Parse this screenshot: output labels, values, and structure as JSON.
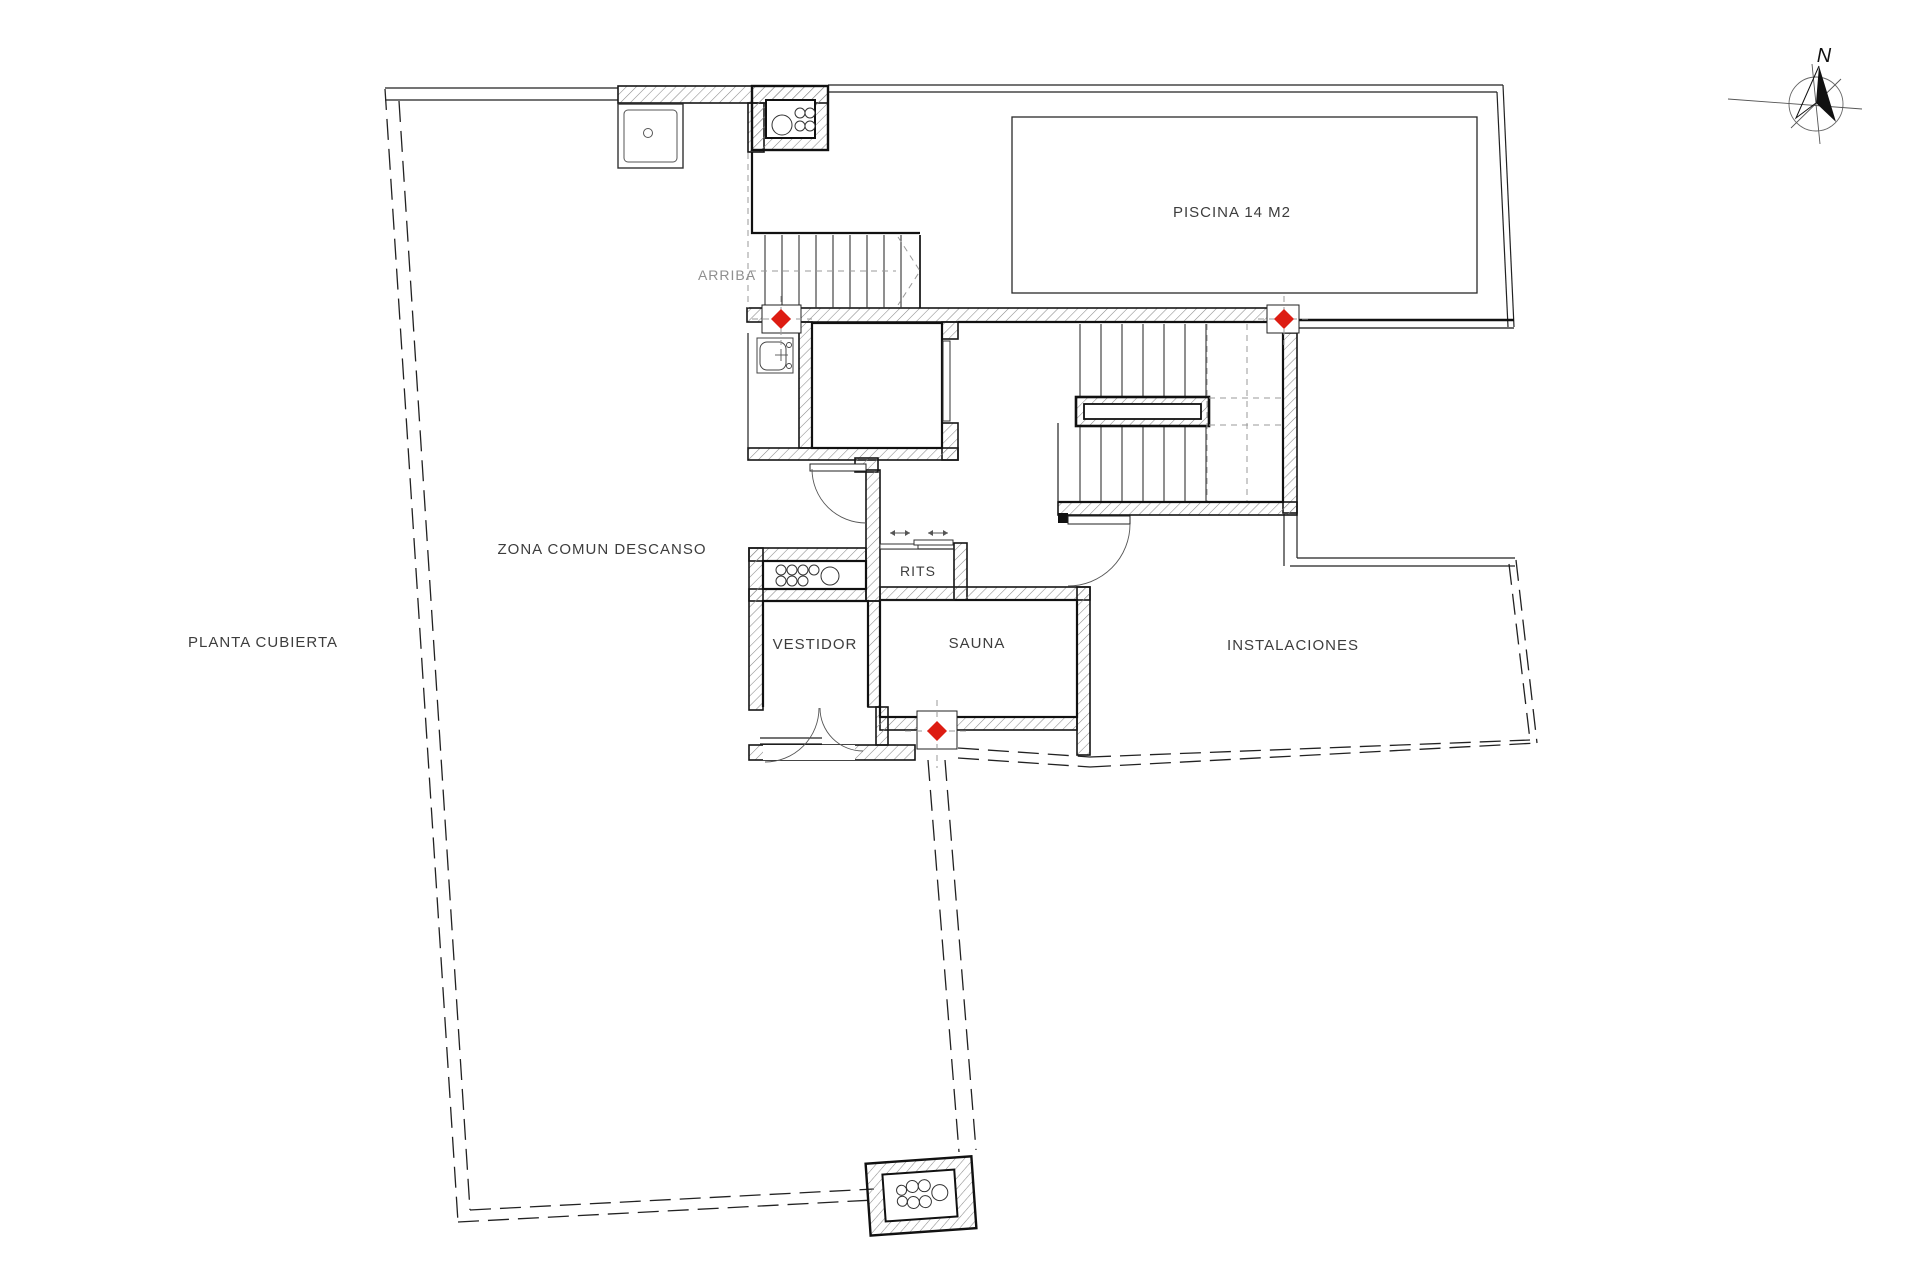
{
  "title": "PLANTA CUBIERTA",
  "plan": {
    "labels": {
      "plan_title": "PLANTA CUBIERTA",
      "arriba": "ARRIBA",
      "north": "N"
    },
    "rooms": [
      {
        "id": "zona-comun-descanso",
        "label": "ZONA COMUN DESCANSO"
      },
      {
        "id": "piscina",
        "label": "PISCINA 14 M2"
      },
      {
        "id": "rits",
        "label": "RITS"
      },
      {
        "id": "vestidor",
        "label": "VESTIDOR"
      },
      {
        "id": "sauna",
        "label": "SAUNA"
      },
      {
        "id": "instalaciones",
        "label": "INSTALACIONES"
      }
    ],
    "markers": {
      "symbol": "red-diamond",
      "count": 3
    },
    "icons": {
      "north_arrow": "north-compass-arrow",
      "shower": "shower-tray",
      "sink": "wash-basin",
      "shafts": "pipe-cluster-shaft",
      "stairs": "stair-flight"
    },
    "colors": {
      "marker": "#dd1c12",
      "line": "#1a1a1a",
      "hatch": "#8a8a8a",
      "background": "#ffffff"
    }
  }
}
